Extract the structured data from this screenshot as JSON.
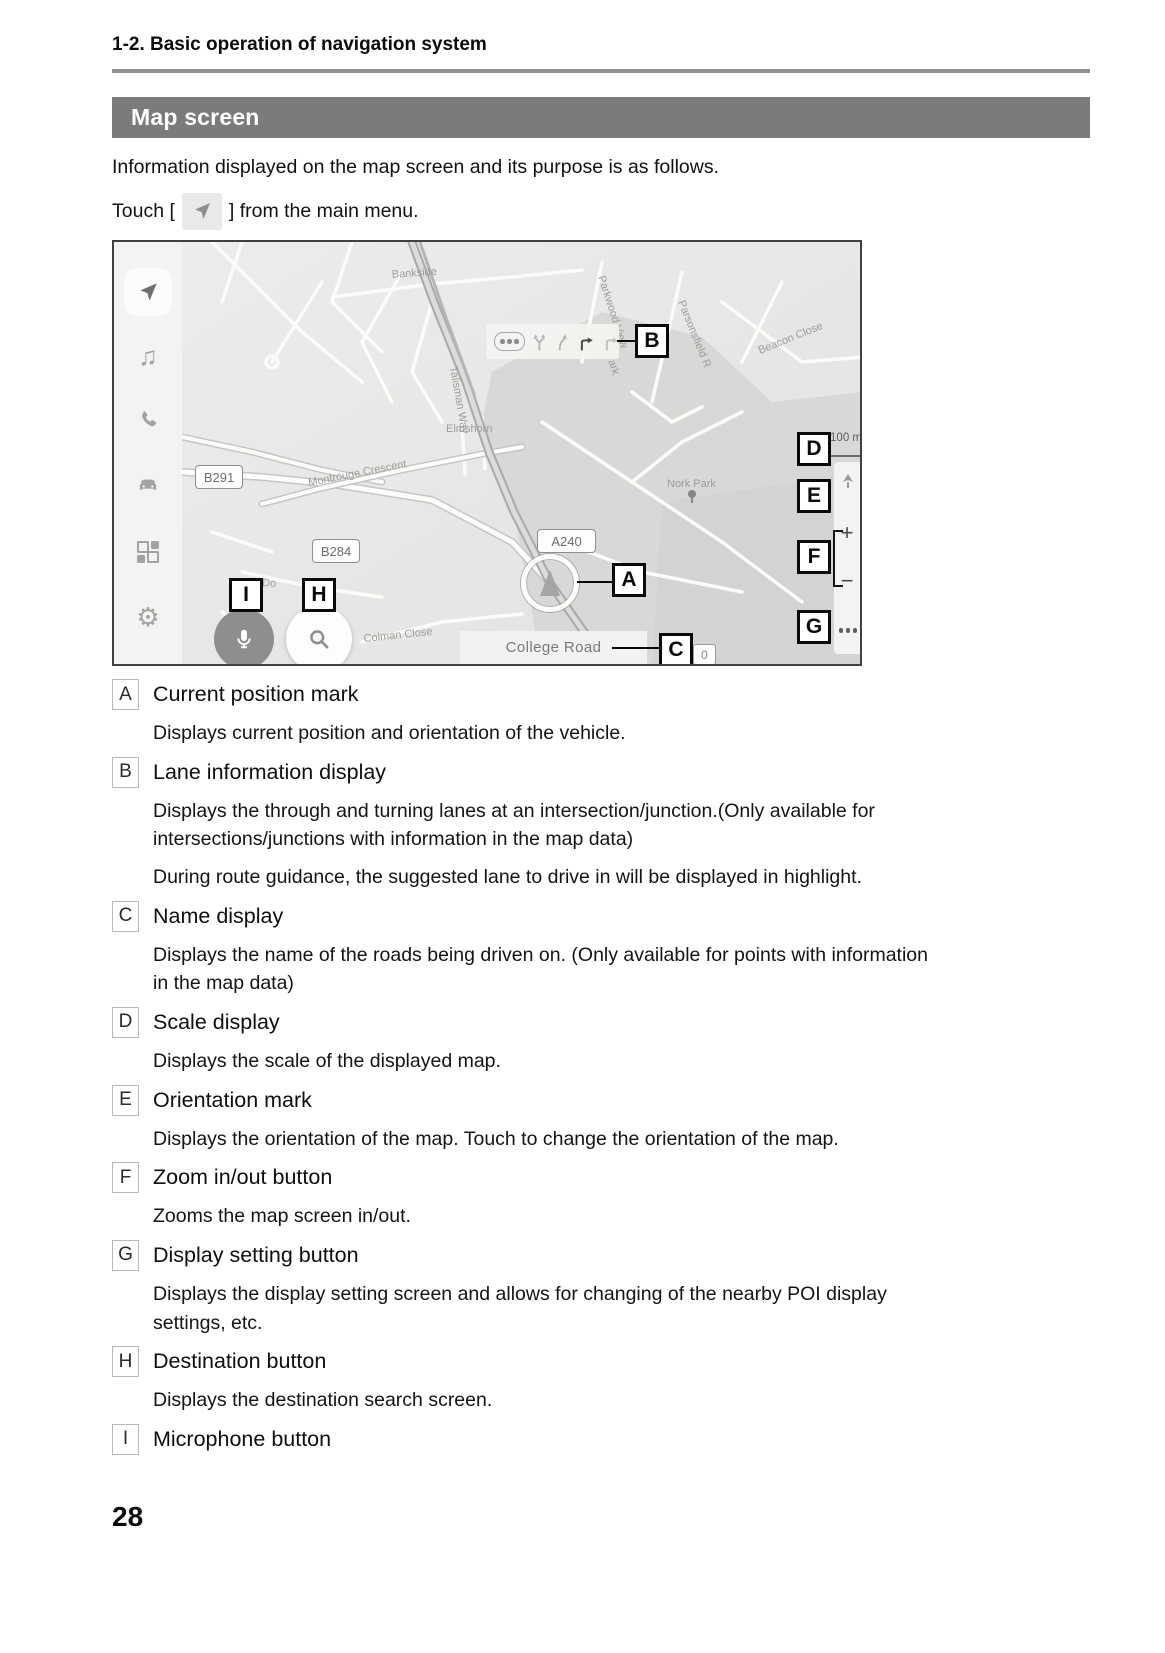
{
  "header": {
    "section": "1-2. Basic operation of navigation system"
  },
  "banner": {
    "title": "Map screen"
  },
  "intro": {
    "line1": "Information displayed on the map screen and its purpose is as follows.",
    "touch_before": "Touch [",
    "touch_after": "] from the main menu."
  },
  "map": {
    "callouts": {
      "a": "A",
      "b": "B",
      "c": "C",
      "d": "D",
      "e": "E",
      "f": "F",
      "g": "G",
      "h": "H",
      "i": "I"
    },
    "roads": {
      "b291": "B291",
      "b284": "B284",
      "a240": "A240"
    },
    "names": {
      "bankside": "Bankside",
      "talisman": "Talisman Way",
      "montrouge": "Montrouge Crescent",
      "elmshorn": "Elmshorn",
      "nork_park": "Nork Park",
      "parsonsfield": "Parsonsfield R",
      "parkwood": "Parkwood View",
      "park": "Park",
      "beacon": "Beacon Close",
      "colman": "Colman Close",
      "dor": "Do"
    },
    "street_display": "College Road",
    "counter": "0",
    "scale": "100 m",
    "zoom_in": "+",
    "zoom_out": "−",
    "sidebar_icons": [
      "navigation-icon",
      "music-icon",
      "phone-icon",
      "car-icon",
      "apps-icon",
      "settings-icon"
    ]
  },
  "legend": {
    "items": [
      {
        "key": "A",
        "title": "Current position mark",
        "paragraphs": [
          "Displays current position and orientation of the vehicle."
        ]
      },
      {
        "key": "B",
        "title": "Lane information display",
        "paragraphs": [
          "Displays the through and turning lanes at an intersection/junction.(Only available for intersections/junctions with information in the map data)",
          "During route guidance, the suggested lane to drive in will be displayed in highlight."
        ]
      },
      {
        "key": "C",
        "title": "Name display",
        "paragraphs": [
          "Displays the name of the roads being driven on. (Only available for points with information in the map data)"
        ]
      },
      {
        "key": "D",
        "title": "Scale display",
        "paragraphs": [
          "Displays the scale of the displayed map."
        ]
      },
      {
        "key": "E",
        "title": "Orientation mark",
        "paragraphs": [
          "Displays the orientation of the map. Touch to change the orientation of the map."
        ]
      },
      {
        "key": "F",
        "title": "Zoom in/out button",
        "paragraphs": [
          "Zooms the map screen in/out."
        ]
      },
      {
        "key": "G",
        "title": "Display setting button",
        "paragraphs": [
          "Displays the display setting screen and allows for changing of the nearby POI display settings, etc."
        ]
      },
      {
        "key": "H",
        "title": "Destination button",
        "paragraphs": [
          "Displays the destination search screen."
        ]
      },
      {
        "key": "I",
        "title": "Microphone button",
        "paragraphs": []
      }
    ]
  },
  "footer": {
    "page_number": "28"
  }
}
